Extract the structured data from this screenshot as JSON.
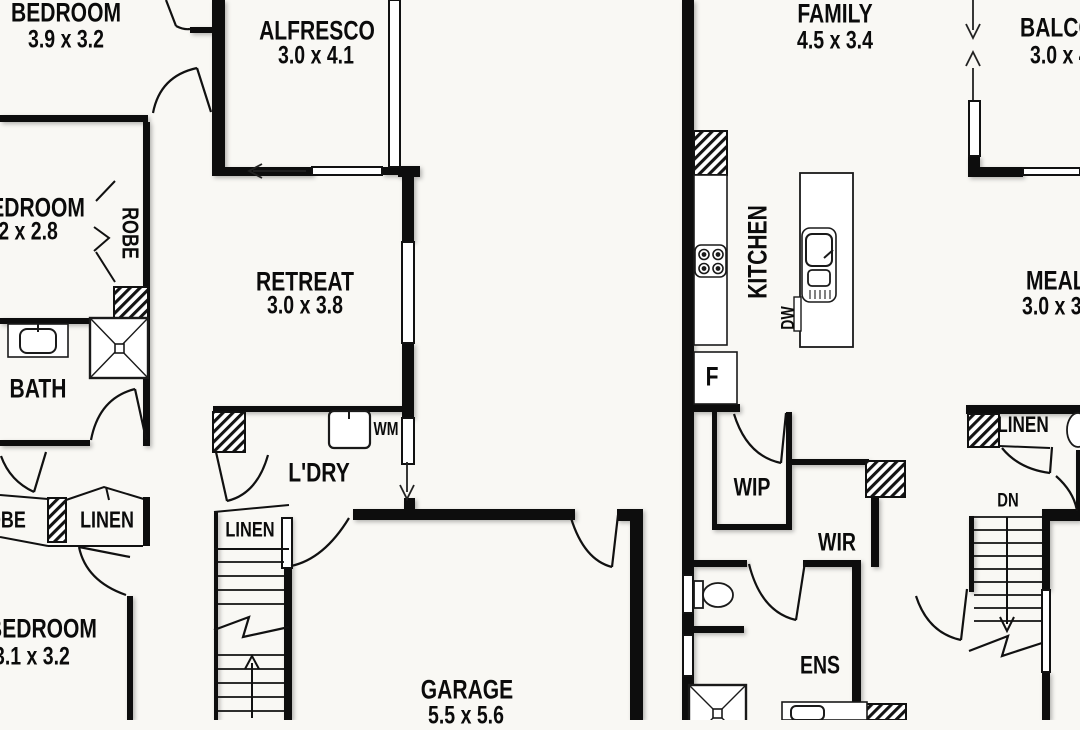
{
  "left": {
    "bedroom1": {
      "name": "BEDROOM",
      "dims": "3.9 x 3.2"
    },
    "alfresco": {
      "name": "ALFRESCO",
      "dims": "3.0 x 4.1"
    },
    "bedroom2": {
      "name": "BEDROOM",
      "dims": "3.2 x 2.8"
    },
    "robe": "ROBE",
    "bath": "BATH",
    "retreat": {
      "name": "RETREAT",
      "dims": "3.0 x 3.8"
    },
    "laundry": "L'DRY",
    "wm": "WM",
    "robe2": "ROBE",
    "linen": "LINEN",
    "bedroom3": {
      "name": "BEDROOM",
      "dims": "3.1 x 3.2"
    },
    "stair_linen": "LINEN",
    "garage": {
      "name": "GARAGE",
      "dims": "5.5 x 5.6"
    }
  },
  "right": {
    "family": {
      "name": "FAMILY",
      "dims": "4.5 x 3.4"
    },
    "balcony": {
      "name": "BALCONY",
      "dims": "3.0 x 4.1"
    },
    "kitchen": "KITCHEN",
    "dw": "DW",
    "fridge": "F",
    "meals": {
      "name": "MEALS",
      "dims": "3.0 x 3.8"
    },
    "wip": "WIP",
    "wir": "WIR",
    "ens": "ENS",
    "linen": "LINEN",
    "stairs_down": "DN"
  }
}
